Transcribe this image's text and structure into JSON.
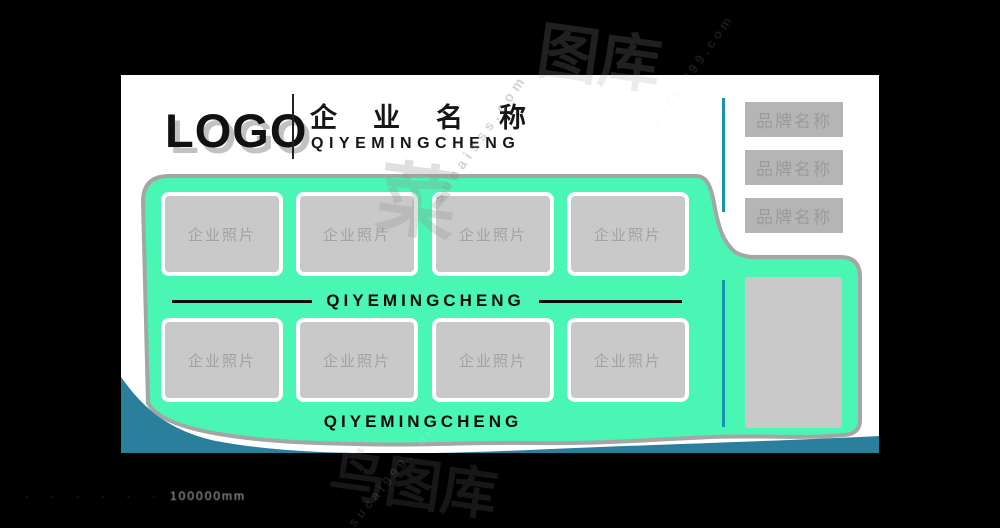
{
  "colors": {
    "background": "#000000",
    "card": "#ffffff",
    "green": "#49f6b4",
    "green_border": "#a5a5a5",
    "teal_wave": "#2a7f9d",
    "accent_cyan": "#1793ae",
    "placeholder_gray": "#c9c9c9",
    "button_gray": "#b5b5b5",
    "button_text_gray": "#9a9a9a",
    "text_black": "#0c0c0c"
  },
  "header": {
    "logo": "LOGO",
    "company_name": "企业名称",
    "company_pinyin": "QIYEMINGCHENG"
  },
  "dividers": {
    "middle_text": "QIYEMINGCHENG",
    "bottom_text": "QIYEMINGCHENG"
  },
  "photos": {
    "labels": [
      "企业照片",
      "企业照片",
      "企业照片",
      "企业照片",
      "企业照片",
      "企业照片",
      "企业照片",
      "企业照片"
    ]
  },
  "brand_buttons": [
    "品牌名称",
    "品牌名称",
    "品牌名称"
  ],
  "footer": {
    "lead": "· · · · · ·",
    "text": "100000mm"
  },
  "watermarks": {
    "cai": "菜",
    "sucai_mid": "sucaisss.com",
    "tuku_top": "图库",
    "sucai_top": "sucai999.com",
    "niao_bottom": "鸟图库",
    "sucai_bottom": "sucai999.com"
  }
}
